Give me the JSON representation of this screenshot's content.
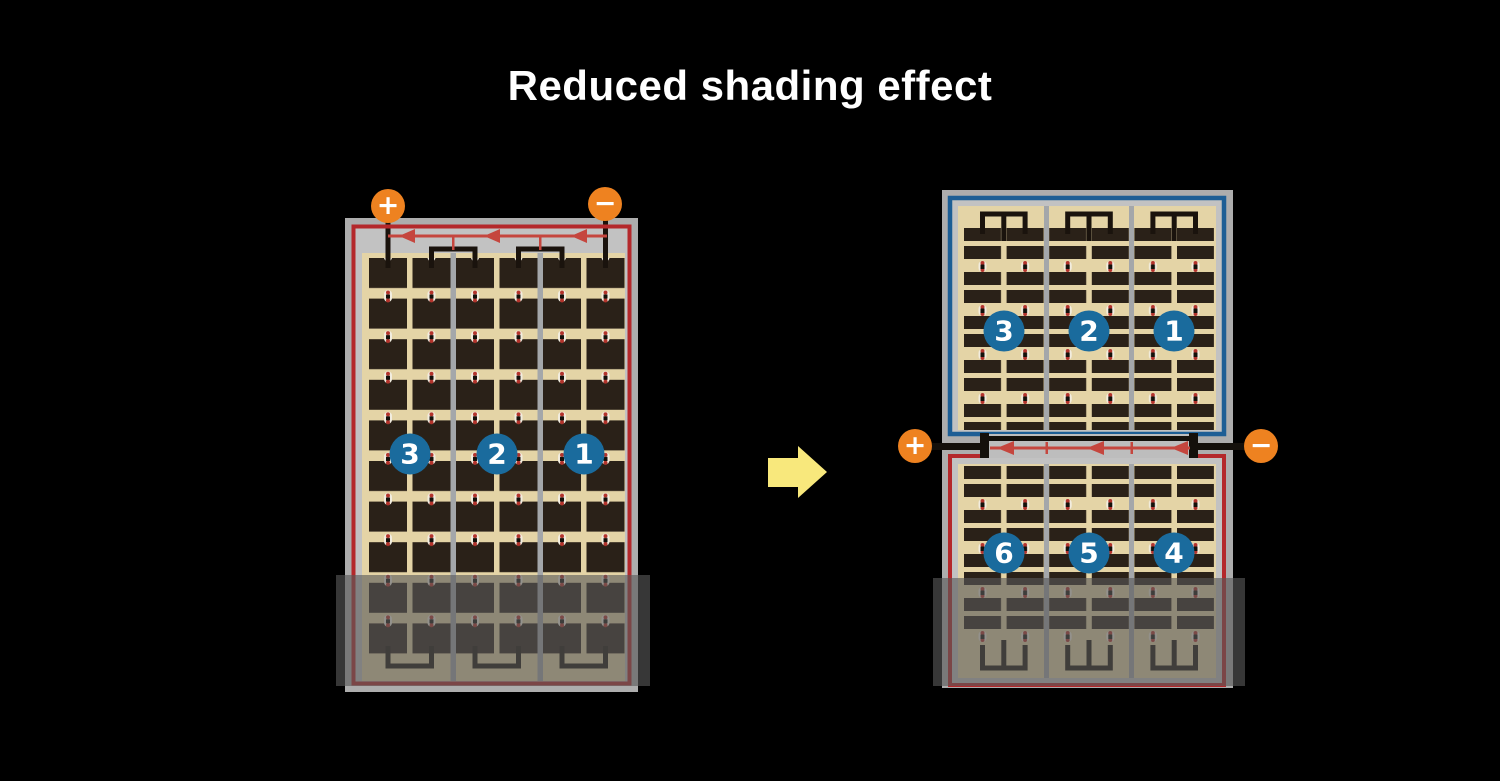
{
  "title": "Reduced shading effect",
  "left_panel": {
    "terminal_positive": "+",
    "terminal_negative": "−",
    "strings": [
      {
        "label": "3"
      },
      {
        "label": "2"
      },
      {
        "label": "1"
      }
    ]
  },
  "right_panel": {
    "terminal_positive": "+",
    "terminal_negative": "−",
    "top_strings": [
      {
        "label": "3"
      },
      {
        "label": "2"
      },
      {
        "label": "1"
      }
    ],
    "bottom_strings": [
      {
        "label": "6"
      },
      {
        "label": "5"
      },
      {
        "label": "4"
      }
    ]
  },
  "colors": {
    "background": "#000000",
    "title_text": "#ffffff",
    "frame_gray": "#adadad",
    "inner_gray": "#c2c2c2",
    "cell_tan": "#e4d4a6",
    "cell_dark": "#2a2118",
    "divider_gray": "#a4a7aa",
    "border_red": "#b4282b",
    "border_blue": "#1d5e95",
    "circle_blue": "#1a6b9d",
    "terminal_orange": "#ee8220",
    "diode_red": "#c5463e",
    "wire_black": "#1a130d",
    "arrow_yellow": "#f8e87c",
    "shade_overlay": "rgba(88,88,88,0.62)"
  }
}
